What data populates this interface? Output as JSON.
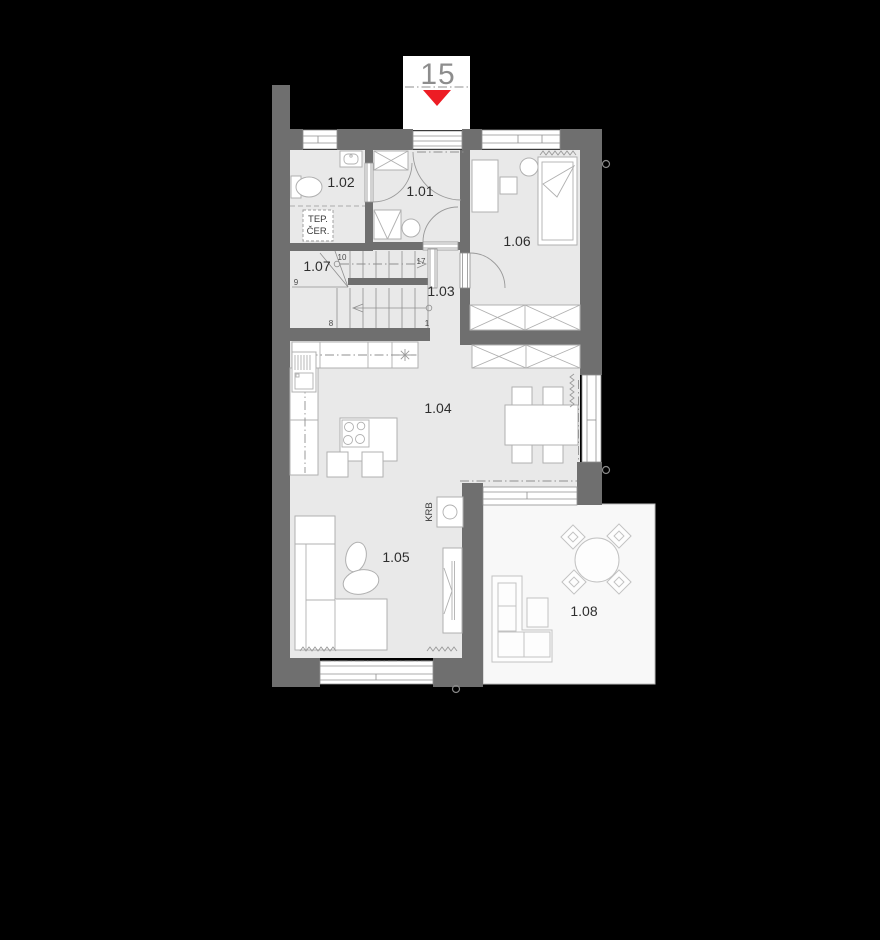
{
  "unit_label": "15",
  "room_labels": {
    "r101": "1.01",
    "r102": "1.02",
    "r103": "1.03",
    "r104": "1.04",
    "r105": "1.05",
    "r106": "1.06",
    "r107": "1.07",
    "r108": "1.08"
  },
  "stair_numbers": {
    "n1": "1",
    "n8": "8",
    "n9": "9",
    "n10": "10",
    "n17": "17"
  },
  "labels": {
    "heat_pump_line1": "TEP.",
    "heat_pump_line2": "ČER.",
    "fireplace": "KRB"
  },
  "colors": {
    "background": "#000000",
    "wall": "#6f6f6f",
    "floor": "#e9e9e9",
    "terrace": "#f8f8f8",
    "entry_marker_red": "#ed1c24",
    "line_gray": "#9a9a9a"
  }
}
